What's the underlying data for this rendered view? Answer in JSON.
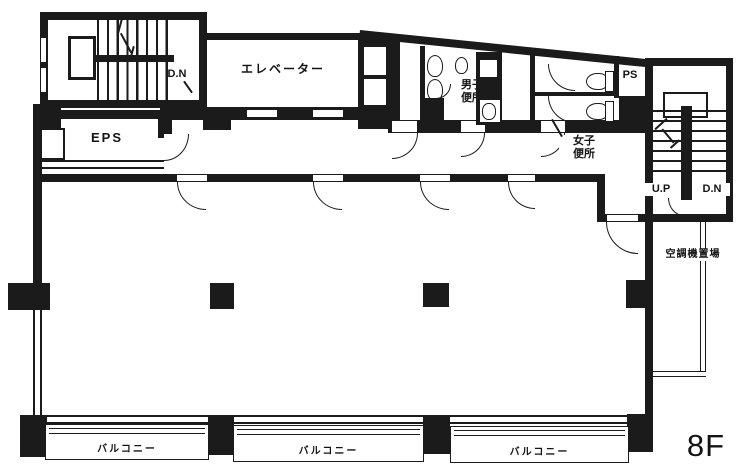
{
  "floor_label": "8F",
  "colors": {
    "ink": "#1b1b1b",
    "background": "#ffffff"
  },
  "labels": {
    "stairs_top_left_dn": "D.N",
    "elevator": "エレベーター",
    "eps": "EPS",
    "mens_toilet_line1": "男子",
    "mens_toilet_line2": "便所",
    "ps": "PS",
    "womens_toilet_line1": "女子",
    "womens_toilet_line2": "便所",
    "stairs_right_up": "U.P",
    "stairs_right_dn": "D.N",
    "ac_equipment_area": "空調機置場",
    "balconies": [
      {
        "label": "バルコニー"
      },
      {
        "label": "バルコニー"
      },
      {
        "label": "バルコニー"
      }
    ]
  }
}
